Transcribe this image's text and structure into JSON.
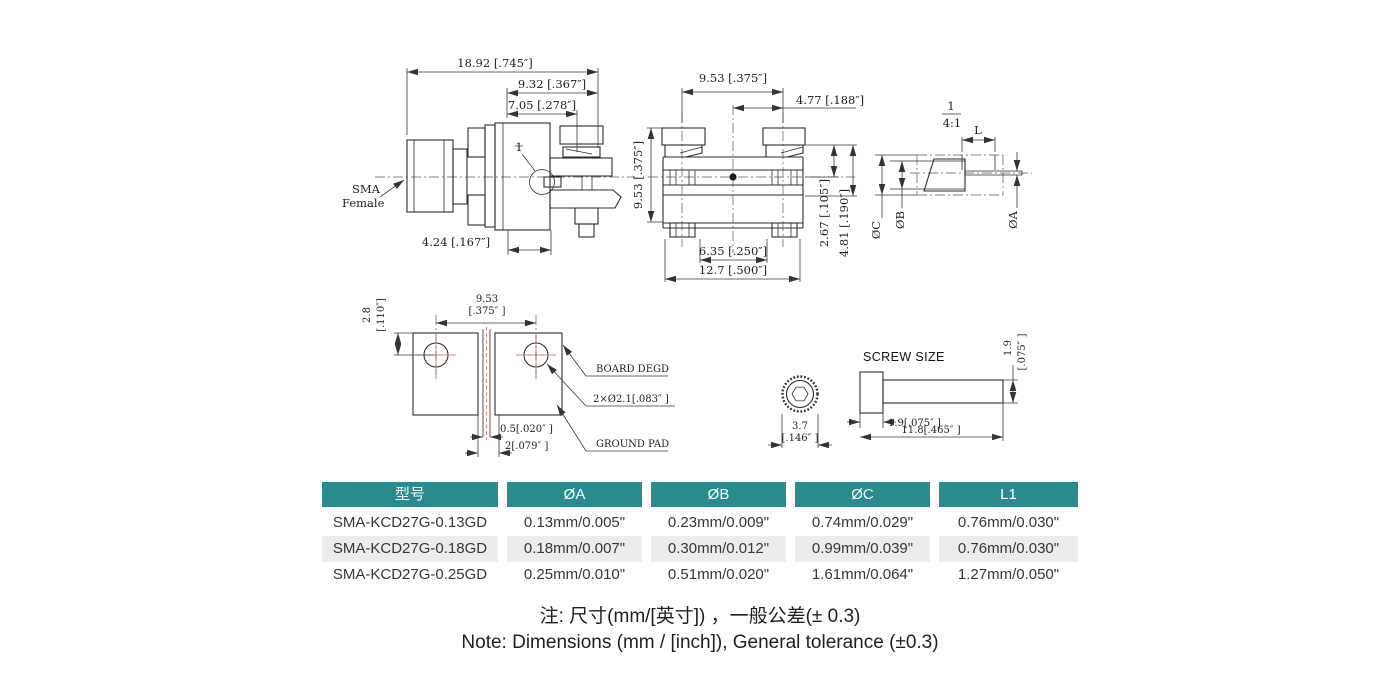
{
  "drawings": {
    "side_view": {
      "dim_total": "18.92 [.745″]",
      "dim_932": "9.32 [.367″]",
      "dim_705": "7.05 [.278″]",
      "dim_424": "4.24 [.167″]",
      "label_sma": "SMA",
      "label_female": "Female",
      "callout": "1"
    },
    "front_view": {
      "dim_953_top": "9.53 [.375″]",
      "dim_477": "4.77 [.188″]",
      "dim_953_left": "9.53 [.375″]",
      "dim_635": "6.35 [.250″]",
      "dim_127": "12.7 [.500″]",
      "dim_267": "2.67 [.105″]",
      "dim_481": "4.81 [.190″]"
    },
    "detail_view": {
      "callout_num": "1",
      "scale": "4:1",
      "dim_l": "L",
      "dia_c": "ØC",
      "dia_b": "ØB",
      "dia_a": "ØA"
    },
    "board_view": {
      "dim_28": "2.8",
      "dim_28_in": "[.110″]",
      "dim_953": "9.53",
      "dim_953_in": "[.375″ ]",
      "dim_05": "0.5[.020″ ]",
      "dim_2": "2[.079″ ]",
      "label_board": "BOARD DEGD",
      "label_holes": "2×Ø2.1[.083″ ]",
      "label_ground": "GROUND PAD"
    },
    "screw_view": {
      "title": "SCREW SIZE",
      "dim_37": "3.7",
      "dim_37_in": "[.146″ ]",
      "dim_19": "1.9[.075″ ]",
      "dim_118": "11.8[.465″ ]",
      "dim_19v": "1.9",
      "dim_19v_in": "[.075″ ]"
    }
  },
  "table": {
    "header_bg": "#2a8b8e",
    "row_alt_bg": "#ececec",
    "headers": [
      "型号",
      "ØA",
      "ØB",
      "ØC",
      "L1"
    ],
    "rows": [
      [
        "SMA-KCD27G-0.13GD",
        "0.13mm/0.005\"",
        "0.23mm/0.009\"",
        "0.74mm/0.029\"",
        "0.76mm/0.030\""
      ],
      [
        "SMA-KCD27G-0.18GD",
        "0.18mm/0.007\"",
        "0.30mm/0.012\"",
        "0.99mm/0.039\"",
        "0.76mm/0.030\""
      ],
      [
        "SMA-KCD27G-0.25GD",
        "0.25mm/0.010\"",
        "0.51mm/0.020\"",
        "1.61mm/0.064\"",
        "1.27mm/0.050\""
      ]
    ]
  },
  "notes": {
    "cn": "注: 尺寸(mm/[英寸]) ，一般公差(± 0.3)",
    "en": "Note: Dimensions (mm / [inch]), General tolerance (±0.3)"
  }
}
